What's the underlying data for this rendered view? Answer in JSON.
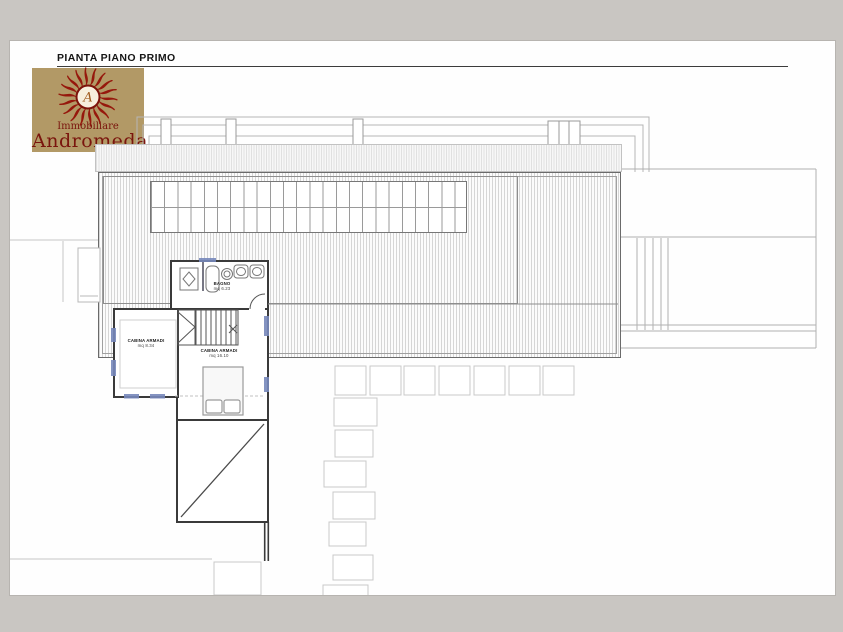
{
  "header": {
    "title": "PIANTA PIANO PRIMO"
  },
  "logo": {
    "line1": "Immobiliare",
    "line2": "Andromeda",
    "monogram": "A"
  },
  "rooms": [
    {
      "label": "BAGNO",
      "area": "mq 6.23"
    },
    {
      "label": "CABINA ARMADI",
      "area": "mq 8.34"
    },
    {
      "label": "CABINA ARMADI",
      "area": "mq 16.10"
    }
  ],
  "colors": {
    "page_surround": "#c9c6c2",
    "logo_background": "#b29966",
    "logo_red": "#96180c",
    "wall": "#3a3a3a",
    "window_blue": "#7788bb"
  }
}
